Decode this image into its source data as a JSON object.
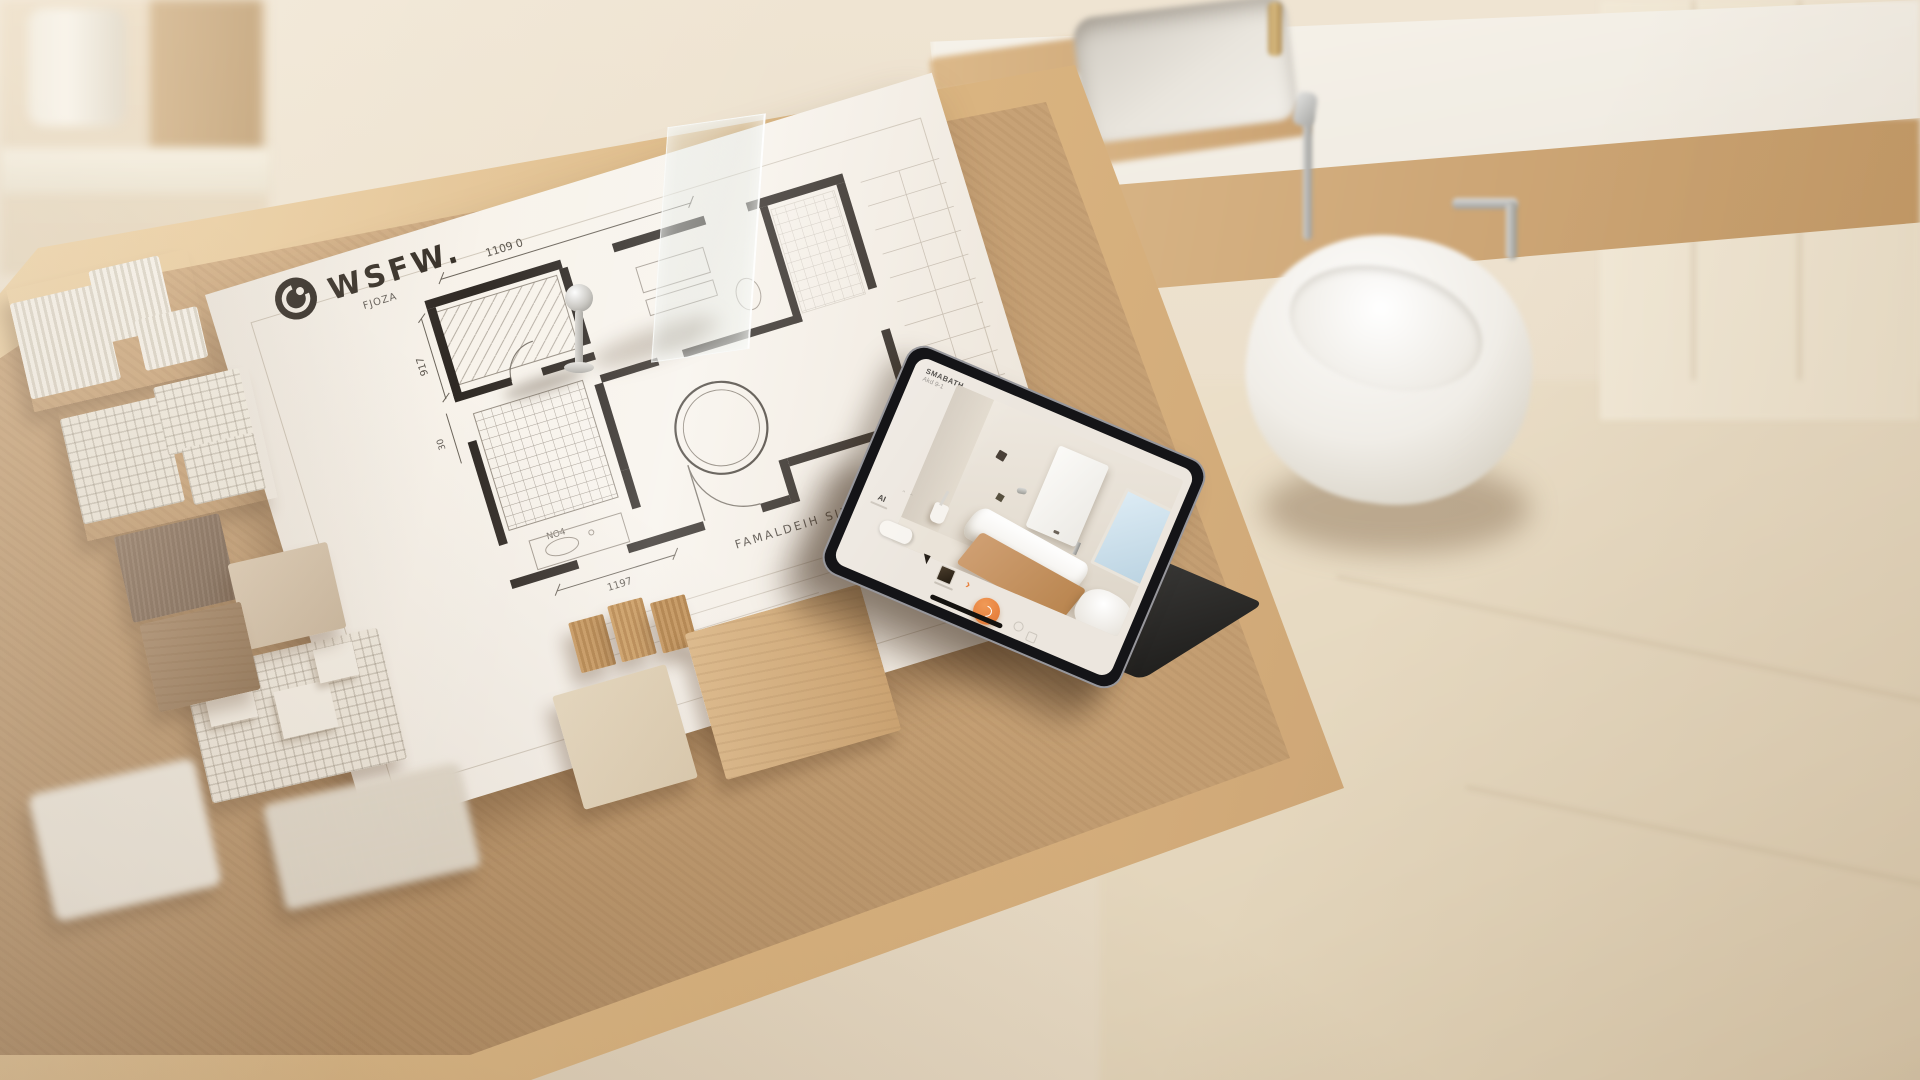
{
  "blueprint": {
    "title": "WSFW.",
    "dim_top": "1109 0",
    "dim_left_upper": "917",
    "dim_left_lower": "30",
    "dim_bottom": "1197",
    "note_upper": "FJOZA",
    "note_mid": "NO4",
    "caption": "FAMALDEIH SILIVO"
  },
  "tablet": {
    "header_line1": "SMABATH",
    "header_line2": "Akd 9-1",
    "toolbar": {
      "ai_glyph": "AI",
      "chevron_glyph": "›"
    }
  },
  "colors": {
    "accent_orange": "#e8823f",
    "cork": "#c9a379",
    "wood_frame": "#dcba8c",
    "paper": "#f7f2ea",
    "ink": "#1d1712",
    "tablet_bezel": "#141417",
    "screen_chrome": "#ece6de",
    "render_vanity_wood": "#c6986d",
    "window_blue": "#cfe2ef"
  }
}
